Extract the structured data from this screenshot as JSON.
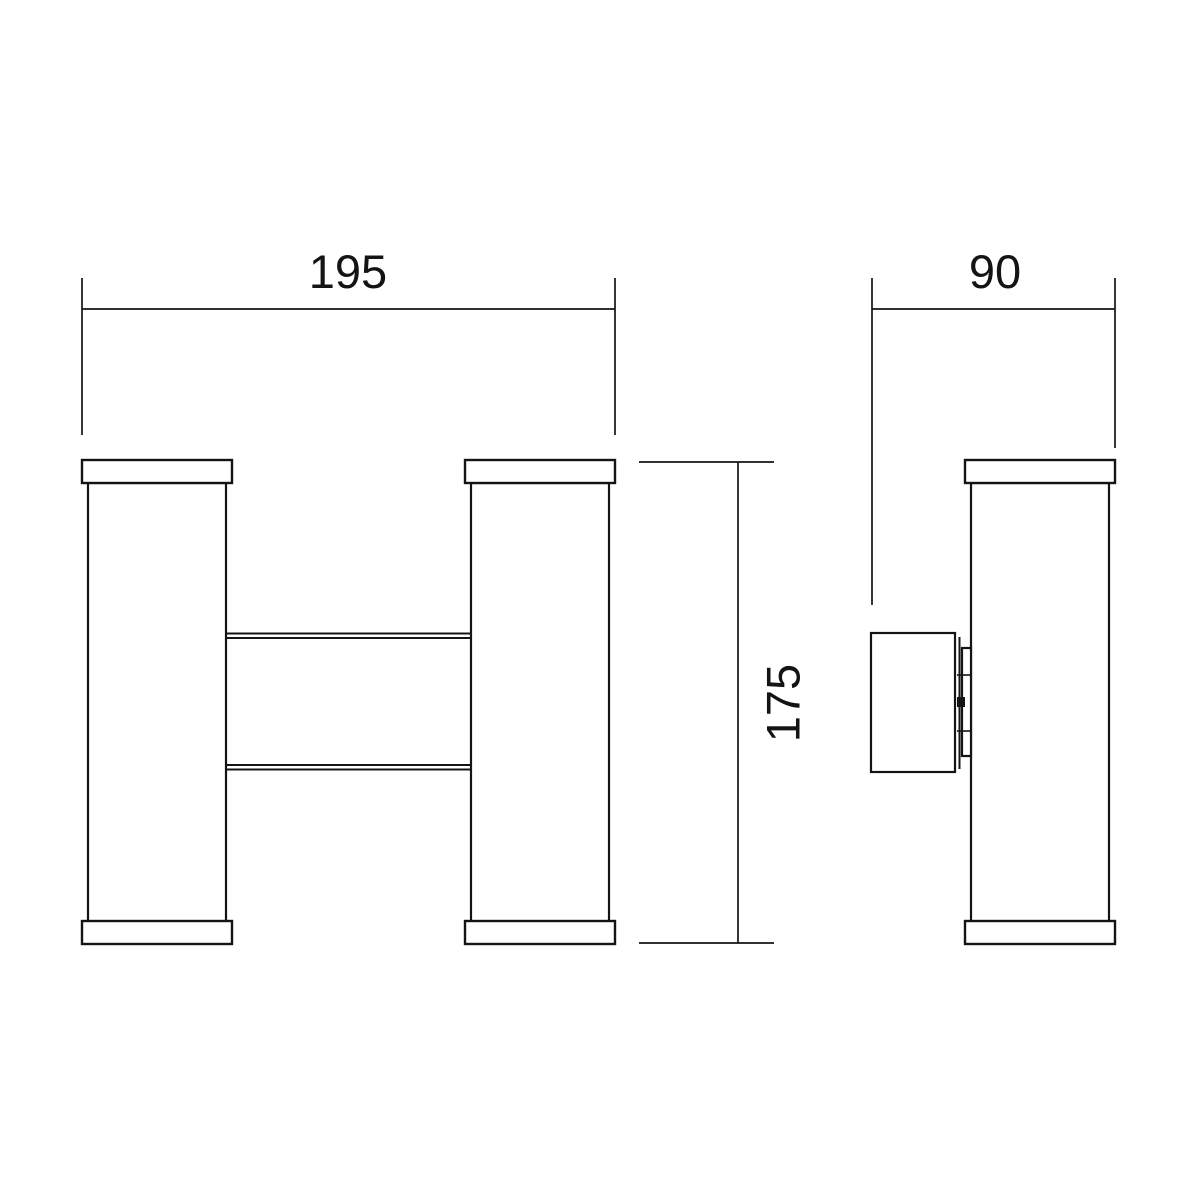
{
  "drawing": {
    "type": "technical-dimension-drawing",
    "subject": "double-cylinder up-down wall light fixture",
    "background_color": "#ffffff",
    "line_color": "#141414",
    "units": "mm",
    "views": {
      "front": {
        "name": "front view",
        "description": "two vertical cylinders with end caps joined by a central connecting bracket (H shape)"
      },
      "side": {
        "name": "side view",
        "description": "single cylinder profile with wall-mount box and bracket plate on the left"
      }
    },
    "dimensions": {
      "width": {
        "value": 195,
        "label": "195"
      },
      "depth": {
        "value": 90,
        "label": "90"
      },
      "height": {
        "value": 175,
        "label": "175"
      }
    }
  }
}
